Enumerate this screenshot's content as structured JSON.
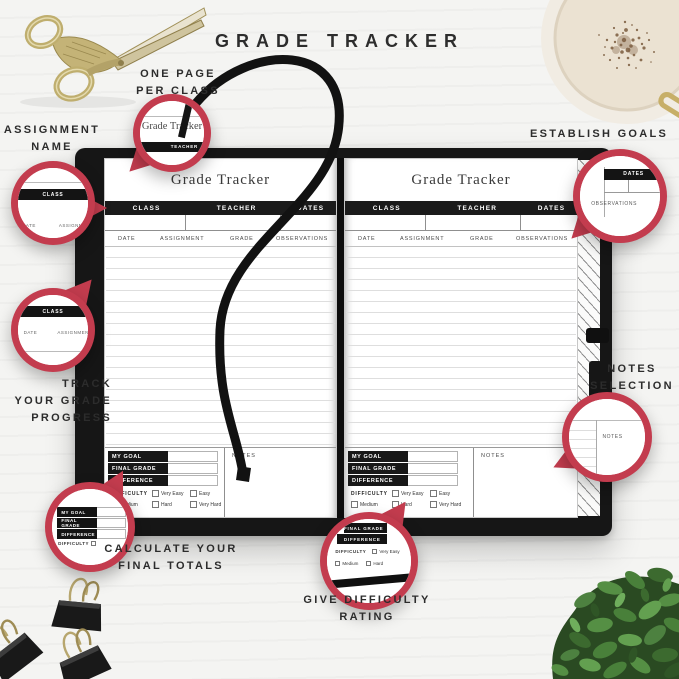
{
  "page_header": {
    "title": "GRADE TRACKER"
  },
  "annotations": {
    "one_page_per_class": "ONE PAGE\nPER CLASS",
    "assignment_name": "ASSIGNMENT\nNAME",
    "track_progress": "TRACK\nYOUR GRADE\nPROGRESS",
    "establish_goals": "ESTABLISH GOALS",
    "notes_selection": "NOTES\nSELECTION",
    "calculate_totals": "CALCULATE YOUR\nFINAL TOTALS",
    "difficulty_rating": "GIVE DIFFICULTY\nRATING"
  },
  "page": {
    "title": "Grade Tracker",
    "header": {
      "class_label": "CLASS",
      "teacher_label": "TEACHER",
      "dates_label": "DATES"
    },
    "columns": [
      "DATE",
      "ASSIGNMENT",
      "GRADE",
      "OBSERVATIONS"
    ],
    "summary": {
      "my_goal": "MY GOAL",
      "final_grade": "FINAL GRADE",
      "difference": "DIFFERENCE"
    },
    "difficulty": {
      "label": "DIFFICULTY",
      "options": [
        "Very Easy",
        "Easy",
        "Medium",
        "Hard",
        "Very Hard"
      ]
    },
    "notes_label": "NOTES"
  },
  "decor": {
    "icons": [
      "stork-scissors-photo",
      "coffee-cup-photo",
      "binder-clips-photo",
      "plant-photo",
      "ribbon-bookmark",
      "pen-loop",
      "magnifier-callout-circle"
    ],
    "colors": {
      "callout_red": "#c33c4e",
      "cover_black": "#161616",
      "gold": "#bfae6e",
      "coffee_foam": "#ebe2d2",
      "leaf_green": "#49803a",
      "page_white": "#ffffff"
    }
  }
}
